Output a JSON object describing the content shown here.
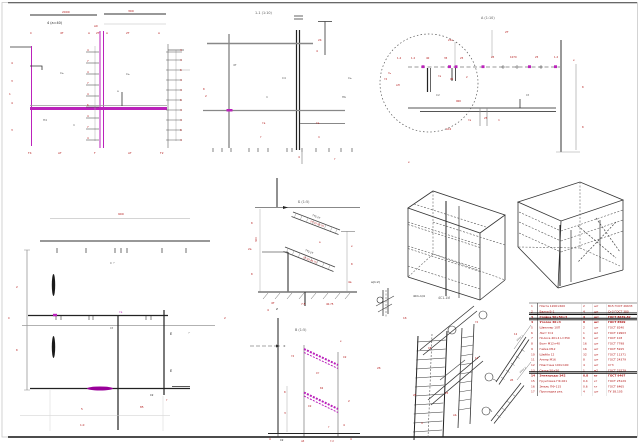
{
  "sheet": {
    "background": "#ffffff",
    "frame_color": "#c8c8c8",
    "top_rule_color": "#444444",
    "bottom_rule_color": "#111111"
  },
  "colors": {
    "r": "#b21414",
    "g": "#555555",
    "k": "#1a1a1a",
    "m": "#bb22bb"
  },
  "views": {
    "section_a_title": "4 (а=40)",
    "section_b_title": "1-1 (1:10)",
    "detail_c_title": "А (1:10)",
    "detail_e_title": "Б (1:5)",
    "detail_f_title": "В (1:5)",
    "iso_caption_1": "4С1-1И",
    "iso_caption_2": "4С1-1/4",
    "sketch_label": "а(1:2)"
  },
  "annotations": [
    [
      47,
      24,
      "4 (а=40)",
      "k",
      3.4
    ],
    [
      62,
      13,
      "2000",
      "r",
      3
    ],
    [
      128,
      12,
      "300",
      "r",
      3
    ],
    [
      94,
      27,
      "А0",
      "r",
      2.8
    ],
    [
      30,
      34,
      "С",
      "r",
      2.8
    ],
    [
      60,
      34,
      "4Т",
      "r",
      2.8
    ],
    [
      88,
      34,
      "А",
      "r",
      2.8
    ],
    [
      96,
      34,
      "2Т",
      "r",
      2.8
    ],
    [
      106,
      34,
      "А",
      "r",
      2.8
    ],
    [
      126,
      34,
      "2Т",
      "r",
      2.8
    ],
    [
      158,
      34,
      "А",
      "r",
      2.8
    ],
    [
      11,
      64,
      "4",
      "r",
      2.8
    ],
    [
      11,
      82,
      "3",
      "r",
      2.8
    ],
    [
      9,
      95,
      "1",
      "r",
      2.8
    ],
    [
      11,
      104,
      "4",
      "r",
      2.8
    ],
    [
      11,
      131,
      "3",
      "r",
      2.8
    ],
    [
      87,
      51,
      "4",
      "r",
      2.6
    ],
    [
      87,
      62,
      "7",
      "r",
      2.6
    ],
    [
      87,
      73,
      "4",
      "r",
      2.6
    ],
    [
      87,
      84,
      "7",
      "r",
      2.6
    ],
    [
      87,
      95,
      "4",
      "r",
      2.6
    ],
    [
      87,
      106,
      "6",
      "r",
      2.6
    ],
    [
      87,
      117,
      "4",
      "r",
      2.6
    ],
    [
      87,
      128,
      "7",
      "r",
      2.6
    ],
    [
      87,
      139,
      "4",
      "r",
      2.6
    ],
    [
      180,
      51,
      "4",
      "r",
      2.6
    ],
    [
      180,
      61,
      "4",
      "r",
      2.6
    ],
    [
      180,
      71,
      "6",
      "r",
      2.6
    ],
    [
      180,
      81,
      "4",
      "r",
      2.6
    ],
    [
      180,
      91,
      "4",
      "r",
      2.6
    ],
    [
      180,
      101,
      "6",
      "r",
      2.6
    ],
    [
      180,
      111,
      "4",
      "r",
      2.6
    ],
    [
      180,
      121,
      "4",
      "r",
      2.6
    ],
    [
      180,
      131,
      "6",
      "r",
      2.6
    ],
    [
      180,
      141,
      "4",
      "r",
      2.6
    ],
    [
      203,
      90,
      "б",
      "r",
      2.8
    ],
    [
      205,
      97,
      "2",
      "r",
      2.8
    ],
    [
      60,
      74,
      "Сь",
      "g",
      2.8
    ],
    [
      126,
      75,
      "Сь",
      "g",
      2.8
    ],
    [
      43,
      121,
      "П4",
      "g",
      2.8
    ],
    [
      73,
      126,
      "п",
      "g",
      2.8
    ],
    [
      117,
      92,
      "а",
      "g",
      2.8
    ],
    [
      28,
      154,
      "Т4",
      "r",
      2.8
    ],
    [
      58,
      154,
      "АТ",
      "r",
      2.8
    ],
    [
      94,
      154,
      "Т",
      "r",
      2.8
    ],
    [
      128,
      154,
      "АТ",
      "r",
      2.8
    ],
    [
      160,
      154,
      "Т2",
      "r",
      2.8
    ],
    [
      255,
      14,
      "1-1 (1:10)",
      "g",
      3.4
    ],
    [
      318,
      41,
      "24",
      "r",
      2.8
    ],
    [
      316,
      52,
      "4",
      "r",
      2.8
    ],
    [
      233,
      66,
      "4Т",
      "g",
      2.8
    ],
    [
      282,
      79,
      "С4",
      "g",
      2.8
    ],
    [
      348,
      79,
      "Сь",
      "g",
      2.8
    ],
    [
      266,
      98,
      "п",
      "g",
      2.8
    ],
    [
      342,
      98,
      "ПЬ",
      "g",
      2.8
    ],
    [
      262,
      124,
      "та",
      "r",
      2.8
    ],
    [
      260,
      138,
      "т",
      "r",
      2.8
    ],
    [
      316,
      124,
      "та",
      "r",
      2.8
    ],
    [
      318,
      138,
      "п",
      "r",
      2.8
    ],
    [
      298,
      158,
      "4",
      "r",
      2.8
    ],
    [
      334,
      160,
      "т",
      "r",
      2.8
    ],
    [
      481,
      19,
      "А (1:10)",
      "g",
      3.4
    ],
    [
      505,
      33,
      "2Т",
      "r",
      2.8
    ],
    [
      448,
      41,
      "25а",
      "r",
      2.6
    ],
    [
      397,
      59,
      "1.4",
      "r",
      2.6
    ],
    [
      411,
      59,
      "1.2",
      "r",
      2.6
    ],
    [
      426,
      59,
      "40",
      "r",
      2.6
    ],
    [
      444,
      59,
      "35",
      "r",
      2.6
    ],
    [
      460,
      59,
      "25",
      "r",
      2.6
    ],
    [
      491,
      58,
      "25",
      "r",
      2.6
    ],
    [
      510,
      58,
      "1070",
      "r",
      2.6
    ],
    [
      535,
      58,
      "25",
      "r",
      2.6
    ],
    [
      554,
      58,
      "1.2",
      "r",
      2.6
    ],
    [
      573,
      61,
      "к",
      "r",
      2.8
    ],
    [
      388,
      74,
      "ть",
      "r",
      2.6
    ],
    [
      384,
      80,
      "т2",
      "r",
      2.6
    ],
    [
      396,
      86,
      "АП",
      "r",
      2.6
    ],
    [
      438,
      77,
      "та",
      "r",
      2.6
    ],
    [
      450,
      80,
      "05",
      "r",
      2.6
    ],
    [
      466,
      78,
      "2",
      "r",
      2.6
    ],
    [
      436,
      96,
      "С2",
      "g",
      2.8
    ],
    [
      526,
      96,
      "Сt",
      "g",
      2.8
    ],
    [
      456,
      102,
      "900",
      "r",
      2.6
    ],
    [
      468,
      121,
      "та",
      "r",
      2.6
    ],
    [
      484,
      119,
      "25",
      "r",
      2.6
    ],
    [
      498,
      121,
      "п",
      "r",
      2.6
    ],
    [
      446,
      130,
      "АС2",
      "r",
      2.6
    ],
    [
      582,
      88,
      "б",
      "r",
      2.8
    ],
    [
      582,
      128,
      "б",
      "r",
      2.8
    ],
    [
      408,
      163,
      "к",
      "r",
      2.8
    ],
    [
      118,
      215,
      "900",
      "r",
      3
    ],
    [
      110,
      264,
      "С ⌐",
      "g",
      2.8
    ],
    [
      16,
      288,
      "2",
      "r",
      2.8
    ],
    [
      16,
      351,
      "б",
      "r",
      2.8
    ],
    [
      119,
      313,
      "та",
      "m",
      2.8
    ],
    [
      110,
      329,
      "Сt",
      "g",
      2.8
    ],
    [
      170,
      335,
      "Е",
      "k",
      3.6
    ],
    [
      170,
      372,
      "Е",
      "k",
      3.6
    ],
    [
      188,
      334,
      "⌐",
      "g",
      2.8
    ],
    [
      224,
      319,
      "2",
      "r",
      2.8
    ],
    [
      8,
      319,
      "С",
      "r",
      2.8
    ],
    [
      81,
      410,
      "5",
      "r",
      2.8
    ],
    [
      140,
      408,
      "85",
      "r",
      2.8
    ],
    [
      80,
      426,
      "1.0",
      "r",
      2.8
    ],
    [
      150,
      396,
      "С2",
      "k",
      2.6
    ],
    [
      166,
      401,
      "т",
      "r",
      2.6
    ],
    [
      298,
      203,
      "Б (1:5)",
      "g",
      3.4
    ],
    [
      251,
      224,
      "б",
      "r",
      2.8
    ],
    [
      248,
      250,
      "2а",
      "r",
      2.8
    ],
    [
      251,
      275,
      "б",
      "r",
      2.8
    ],
    [
      257,
      242,
      "300",
      "r",
      2.6,
      -90
    ],
    [
      312,
      216,
      "ТТ2-2Т",
      "k",
      2.4,
      21
    ],
    [
      310,
      222,
      "2Т·25·40.75",
      "r",
      2.4,
      21
    ],
    [
      305,
      251,
      "ТТ2-2Т",
      "k",
      2.4,
      22
    ],
    [
      303,
      258,
      "2Т·25·40.75",
      "r",
      2.4,
      22
    ],
    [
      351,
      247,
      "к",
      "r",
      2.8
    ],
    [
      351,
      265,
      "б",
      "r",
      2.8
    ],
    [
      348,
      283,
      "4а",
      "r",
      2.8
    ],
    [
      271,
      304,
      "4Т",
      "r",
      2.8
    ],
    [
      301,
      305,
      "7.5",
      "r",
      2.8
    ],
    [
      326,
      305,
      "40.75",
      "r",
      2.6
    ],
    [
      319,
      243,
      "а",
      "r",
      2.5
    ],
    [
      295,
      331,
      "В (1:5)",
      "g",
      3.4
    ],
    [
      267,
      311,
      "4",
      "r",
      2.8
    ],
    [
      276,
      310,
      "Z",
      "k",
      2.8
    ],
    [
      283,
      347,
      "±",
      "k",
      3
    ],
    [
      340,
      342,
      "к",
      "r",
      2.6
    ],
    [
      343,
      358,
      "С2",
      "r",
      2.6
    ],
    [
      291,
      357,
      "т2",
      "r",
      2.6
    ],
    [
      316,
      374,
      "Ст",
      "r",
      2.6
    ],
    [
      320,
      389,
      "б2",
      "r",
      2.6
    ],
    [
      308,
      407,
      "С2",
      "r",
      2.6
    ],
    [
      284,
      393,
      "б",
      "r",
      2.8
    ],
    [
      284,
      414,
      "3",
      "r",
      2.8
    ],
    [
      348,
      402,
      "2",
      "r",
      2.8
    ],
    [
      343,
      426,
      "4",
      "r",
      2.8
    ],
    [
      328,
      428,
      "т",
      "r",
      2.6
    ],
    [
      269,
      440,
      "4",
      "r",
      2.6
    ],
    [
      280,
      441,
      "С2",
      "k",
      2.6
    ],
    [
      301,
      442,
      "об",
      "r",
      2.6
    ],
    [
      330,
      442,
      "т.п",
      "r",
      2.6
    ],
    [
      350,
      440,
      "4",
      "r",
      2.6
    ],
    [
      438,
      299,
      "4С1-1И",
      "g",
      3.2
    ],
    [
      371,
      283,
      "а(1:2)",
      "k",
      3
    ],
    [
      403,
      319,
      "1б",
      "r",
      2.8
    ],
    [
      413,
      297,
      "4С1-1/4",
      "k",
      3
    ],
    [
      377,
      369,
      "2б",
      "r",
      2.8
    ],
    [
      428,
      349,
      "С5",
      "r",
      2.6
    ],
    [
      475,
      323,
      "т2",
      "r",
      2.6
    ],
    [
      475,
      359,
      "12",
      "r",
      2.6
    ],
    [
      413,
      396,
      "25",
      "r",
      2.6
    ],
    [
      445,
      394,
      "25",
      "r",
      2.6
    ],
    [
      453,
      416,
      "АЬ",
      "r",
      2.6
    ],
    [
      421,
      424,
      "4",
      "r",
      2.6
    ],
    [
      514,
      335,
      "12",
      "r",
      2.6
    ],
    [
      510,
      381,
      "2б",
      "r",
      2.6
    ],
    [
      517,
      341,
      "узел 1",
      "g",
      2.5,
      -38
    ],
    [
      520,
      373,
      "узел 2",
      "g",
      2.5,
      -38
    ]
  ],
  "table": {
    "x": 529,
    "y": 303,
    "width": 108,
    "rowH": 5.35,
    "colX": [
      531,
      539.5,
      583,
      594,
      608
    ],
    "text_color": "#b21414",
    "rows": [
      {
        "c": [
          "1",
          "Плита 1200×600",
          "2",
          "шт",
          "В15 ГОСТ 26633"
        ]
      },
      {
        "c": [
          "2",
          "Балка Б-1",
          "4",
          "шт",
          "Ст3 ГОСТ 380"
        ]
      },
      {
        "c": [
          "3",
          "Стойка 50×50×3",
          "4",
          "шт",
          "ГОСТ 8639-82"
        ],
        "sep": "heavy",
        "b": 1
      },
      {
        "c": [
          "4",
          "Уголок 40×4",
          "8",
          "шт",
          "ГОСТ 8509"
        ],
        "sep": "heavy",
        "b": 1
      },
      {
        "c": [
          "5",
          "Швеллер 10П",
          "2",
          "шт",
          "ГОСТ 8240"
        ]
      },
      {
        "c": [
          "6",
          "Лист t=4",
          "1",
          "м2",
          "ГОСТ 19903"
        ]
      },
      {
        "c": [
          "7",
          "Полоса 40×4 L=350",
          "6",
          "шт",
          "ГОСТ 103"
        ]
      },
      {
        "c": [
          "8",
          "Болт М12×40",
          "16",
          "шт",
          "ГОСТ 7798"
        ]
      },
      {
        "c": [
          "9",
          "Гайка М12",
          "16",
          "шт",
          "ГОСТ 5915"
        ]
      },
      {
        "c": [
          "10",
          "Шайба 12",
          "32",
          "шт",
          "ГОСТ 11371"
        ]
      },
      {
        "c": [
          "11",
          "Анкер М16",
          "8",
          "шт",
          "ГОСТ 24379"
        ]
      },
      {
        "c": [
          "12",
          "Пластина 100×100",
          "4",
          "шт",
          "Ст3"
        ]
      },
      {
        "c": [
          "13",
          "Сетка 50×50",
          "1",
          "м2",
          "ГОСТ 23279"
        ]
      },
      {
        "c": [
          "14",
          "Электроды Э42",
          "0.8",
          "кг",
          "ГОСТ 9467"
        ],
        "sep": "heavy",
        "b": 1
      },
      {
        "c": [
          "15",
          "Грунтовка ГФ-021",
          "0.4",
          "кг",
          "ГОСТ 25129"
        ]
      },
      {
        "c": [
          "16",
          "Эмаль ПФ-115",
          "0.6",
          "кг",
          "ГОСТ 6465"
        ]
      },
      {
        "c": [
          "17",
          "Прокладка рез.",
          "4",
          "шт",
          "ТУ 38.105"
        ]
      }
    ]
  }
}
